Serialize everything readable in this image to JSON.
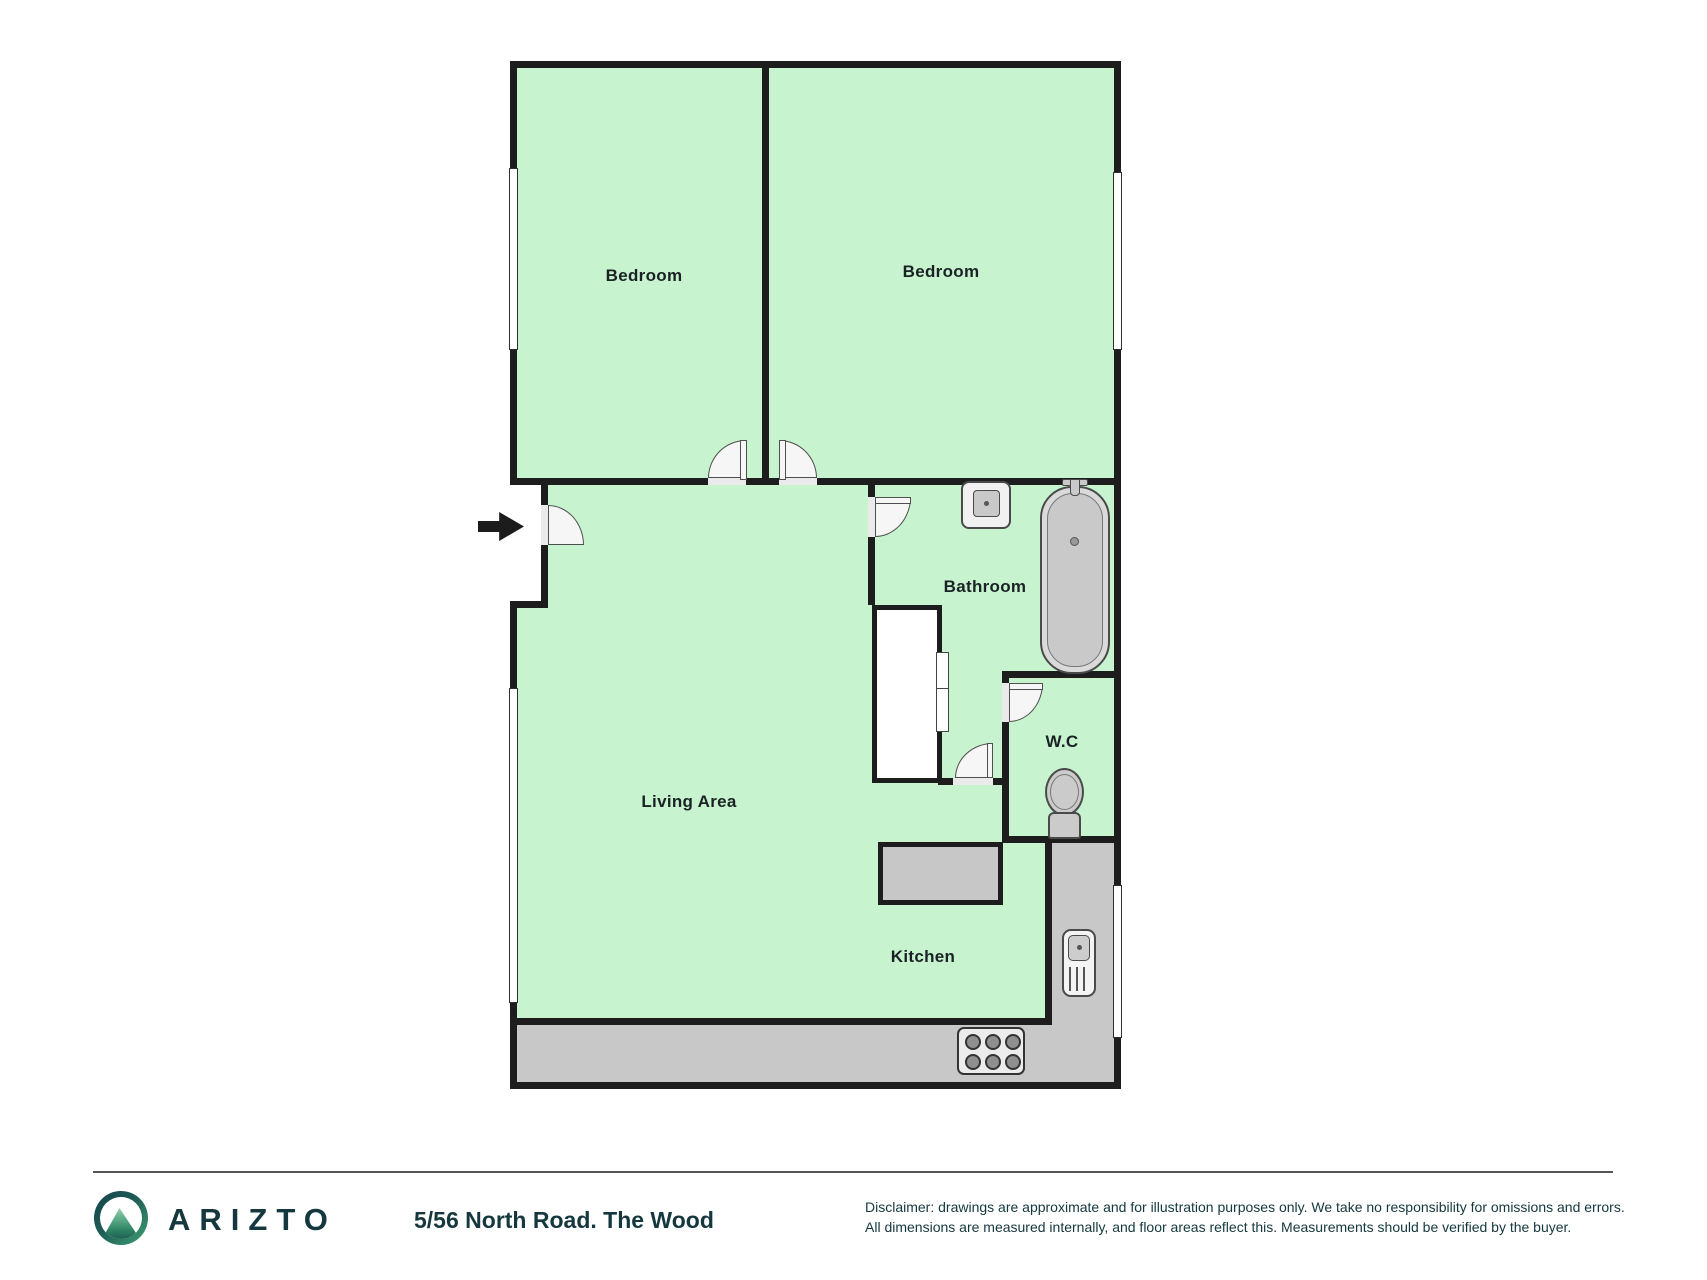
{
  "floorplan": {
    "rooms": {
      "bedroom_left": {
        "label": "Bedroom"
      },
      "bedroom_right": {
        "label": "Bedroom"
      },
      "bathroom": {
        "label": "Bathroom"
      },
      "wc": {
        "label": "W.C"
      },
      "living": {
        "label": "Living Area"
      },
      "kitchen": {
        "label": "Kitchen"
      }
    },
    "icons": [
      "entry-arrow-icon",
      "door-swing-icon",
      "window-icon",
      "bathroom-sink-icon",
      "bathtub-icon",
      "toilet-icon",
      "closet-icon",
      "kitchen-sink-icon",
      "stove-icon",
      "island-counter",
      "mountain-logo-icon"
    ],
    "colors": {
      "wall": "#1d1d1d",
      "floor": "#c7f3ce",
      "counter": "#c8c8c8",
      "door": "#f6f6f6",
      "label_text": "#1b2226",
      "brand_teal": "#14383e",
      "logo_green": "#3fa273"
    }
  },
  "footer": {
    "brand": "ARIZTO",
    "address": "5/56 North Road. The Wood",
    "disclaimer_line1": "Disclaimer: drawings are approximate and for illustration purposes only. We take no responsibility for omissions and errors.",
    "disclaimer_line2": "All dimensions are measured internally, and floor areas reflect this. Measurements should be verified by the buyer."
  }
}
